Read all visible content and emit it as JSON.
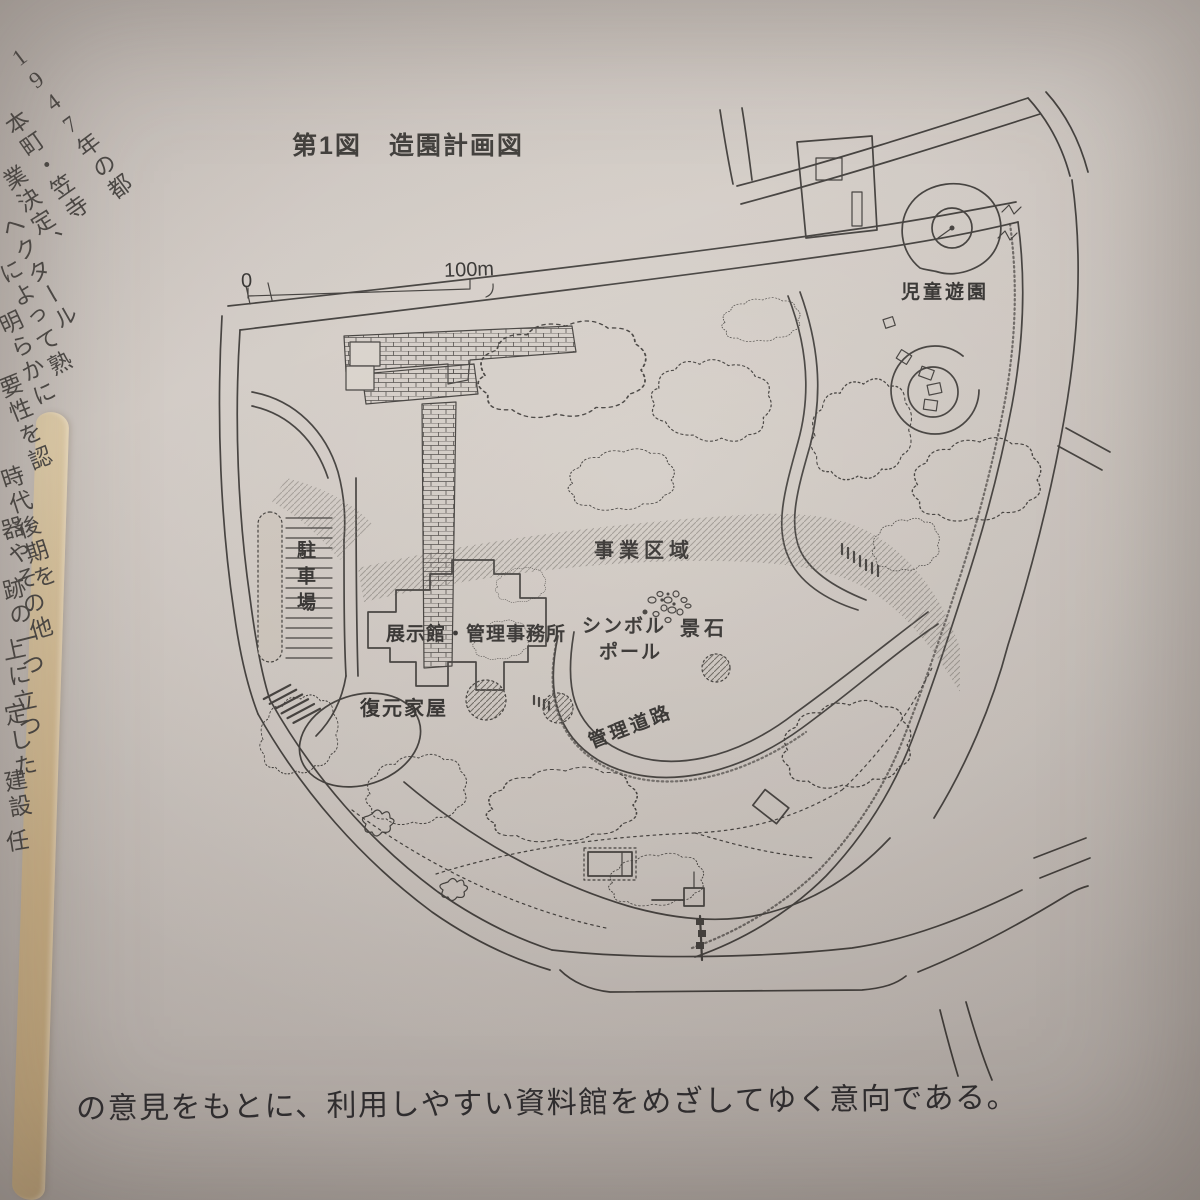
{
  "figure": {
    "title": "第1図　造園計画図"
  },
  "scale_bar": {
    "start_label": "0",
    "end_label": "100m"
  },
  "map_labels": {
    "children_playground": "児童遊園",
    "project_area": "事業区域",
    "parking_lot": "駐車場",
    "exhibition_hall_office": "展示館・管理事務所",
    "symbol_pole_line1": "シンボル",
    "symbol_pole_line2": "ポール",
    "landscape_stones": "景石",
    "restored_house": "復元家屋",
    "management_road": "管理道路"
  },
  "caption_text": "の意見をもとに、利用しやすい資料館をめざしてゆく意向である。",
  "left_margin_fragments": [
    "1947年の都",
    "本町・笠寺",
    "業決定、",
    "ヘクタール",
    "によって熟",
    "明らかに",
    "要性を認",
    "時代後期を",
    "器やその他",
    "跡の一つ",
    "上に立つ",
    "定した",
    "建設",
    "任"
  ]
}
